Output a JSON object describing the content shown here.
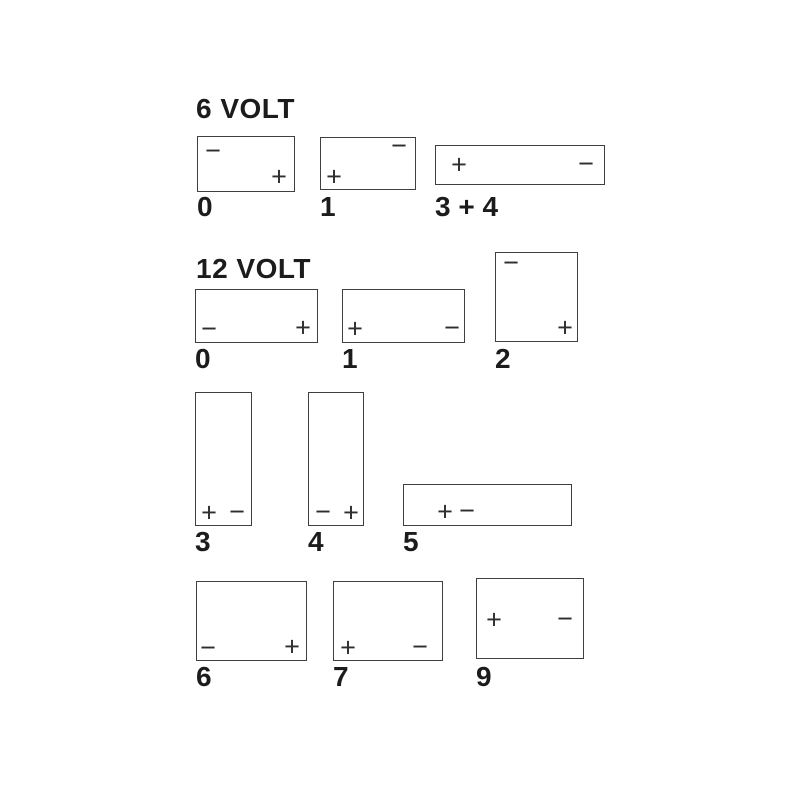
{
  "diagram": {
    "background": "#ffffff",
    "line_color": "#3f3f3f",
    "text_color": "#1c1c1c",
    "symbol_color": "#2e2e2e",
    "sections": [
      {
        "title": "6 VOLT",
        "title_pos": {
          "x": 196,
          "y": 95
        },
        "batteries": [
          {
            "label": "0",
            "box": {
              "x": 197,
              "y": 136,
              "w": 98,
              "h": 56
            },
            "label_pos": {
              "x": 197,
              "y": 193
            },
            "terminals": [
              {
                "symbol": "−",
                "x": 213,
                "y": 151
              },
              {
                "symbol": "+",
                "x": 279,
                "y": 177
              }
            ]
          },
          {
            "label": "1",
            "box": {
              "x": 320,
              "y": 137,
              "w": 96,
              "h": 53
            },
            "label_pos": {
              "x": 320,
              "y": 193
            },
            "terminals": [
              {
                "symbol": "−",
                "x": 399,
                "y": 146
              },
              {
                "symbol": "+",
                "x": 334,
                "y": 177
              }
            ]
          },
          {
            "label": "3 + 4",
            "box": {
              "x": 435,
              "y": 145,
              "w": 170,
              "h": 40
            },
            "label_pos": {
              "x": 435,
              "y": 193
            },
            "terminals": [
              {
                "symbol": "+",
                "x": 459,
                "y": 165
              },
              {
                "symbol": "−",
                "x": 586,
                "y": 164
              }
            ]
          }
        ]
      },
      {
        "title": "12 VOLT",
        "title_pos": {
          "x": 196,
          "y": 255
        },
        "batteries": [
          {
            "label": "0",
            "box": {
              "x": 195,
              "y": 289,
              "w": 123,
              "h": 54
            },
            "label_pos": {
              "x": 195,
              "y": 345
            },
            "terminals": [
              {
                "symbol": "−",
                "x": 209,
                "y": 329
              },
              {
                "symbol": "+",
                "x": 303,
                "y": 328
              }
            ]
          },
          {
            "label": "1",
            "box": {
              "x": 342,
              "y": 289,
              "w": 123,
              "h": 54
            },
            "label_pos": {
              "x": 342,
              "y": 345
            },
            "terminals": [
              {
                "symbol": "+",
                "x": 355,
                "y": 329
              },
              {
                "symbol": "−",
                "x": 452,
                "y": 328
              }
            ]
          },
          {
            "label": "2",
            "box": {
              "x": 495,
              "y": 252,
              "w": 83,
              "h": 90
            },
            "label_pos": {
              "x": 495,
              "y": 345
            },
            "terminals": [
              {
                "symbol": "−",
                "x": 511,
                "y": 263
              },
              {
                "symbol": "+",
                "x": 565,
                "y": 328
              }
            ]
          },
          {
            "label": "3",
            "box": {
              "x": 195,
              "y": 392,
              "w": 57,
              "h": 134
            },
            "label_pos": {
              "x": 195,
              "y": 528
            },
            "terminals": [
              {
                "symbol": "+",
                "x": 209,
                "y": 513
              },
              {
                "symbol": "−",
                "x": 237,
                "y": 512
              }
            ]
          },
          {
            "label": "4",
            "box": {
              "x": 308,
              "y": 392,
              "w": 56,
              "h": 134
            },
            "label_pos": {
              "x": 308,
              "y": 528
            },
            "terminals": [
              {
                "symbol": "−",
                "x": 323,
                "y": 512
              },
              {
                "symbol": "+",
                "x": 351,
                "y": 513
              }
            ]
          },
          {
            "label": "5",
            "box": {
              "x": 403,
              "y": 484,
              "w": 169,
              "h": 42
            },
            "label_pos": {
              "x": 403,
              "y": 528
            },
            "terminals": [
              {
                "symbol": "+",
                "x": 445,
                "y": 512
              },
              {
                "symbol": "−",
                "x": 467,
                "y": 511
              }
            ]
          },
          {
            "label": "6",
            "box": {
              "x": 196,
              "y": 581,
              "w": 111,
              "h": 80
            },
            "label_pos": {
              "x": 196,
              "y": 663
            },
            "terminals": [
              {
                "symbol": "−",
                "x": 208,
                "y": 648
              },
              {
                "symbol": "+",
                "x": 292,
                "y": 647
              }
            ]
          },
          {
            "label": "7",
            "box": {
              "x": 333,
              "y": 581,
              "w": 110,
              "h": 80
            },
            "label_pos": {
              "x": 333,
              "y": 663
            },
            "terminals": [
              {
                "symbol": "+",
                "x": 348,
                "y": 648
              },
              {
                "symbol": "−",
                "x": 420,
                "y": 647
              }
            ]
          },
          {
            "label": "9",
            "box": {
              "x": 476,
              "y": 578,
              "w": 108,
              "h": 81
            },
            "label_pos": {
              "x": 476,
              "y": 663
            },
            "terminals": [
              {
                "symbol": "+",
                "x": 494,
                "y": 620
              },
              {
                "symbol": "−",
                "x": 565,
                "y": 619
              }
            ]
          }
        ]
      }
    ]
  }
}
